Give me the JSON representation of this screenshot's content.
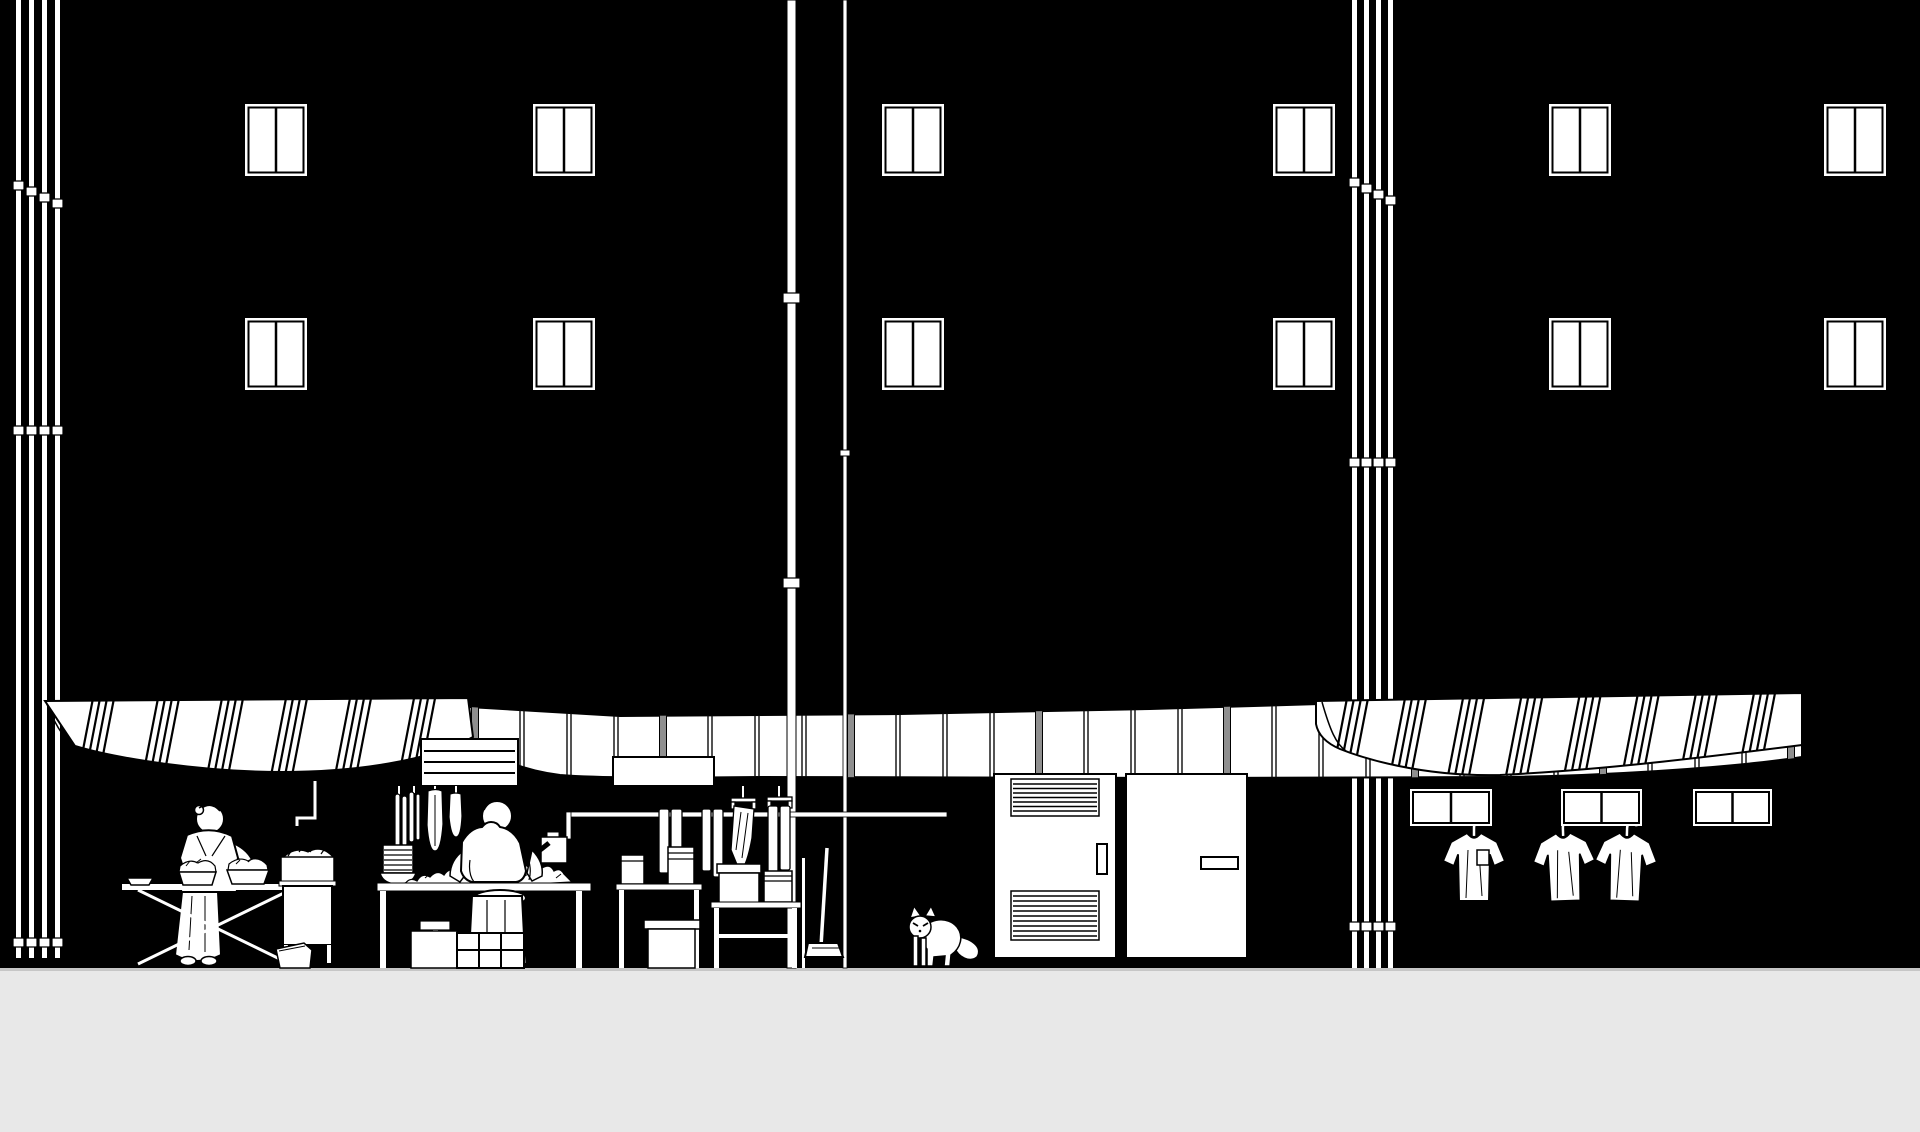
{
  "scene_title": "Night market street elevation",
  "colors": {
    "background": "#000000",
    "ink": "#000000",
    "paper": "#ffffff",
    "ground": "#e8e8e8",
    "ground_edge": "#c6c6c6",
    "awning_divider": "#8f8f8f"
  },
  "counts": {
    "facade_windows": 12,
    "facade_window_rows": 2,
    "facade_window_columns": 6,
    "transom_windows": 3,
    "hanging_shirts": 3,
    "left_downpipes": 4,
    "right_downpipes": 4,
    "center_standpipes": 2,
    "awnings": 3,
    "people": 2,
    "cats": 1,
    "doors": 2
  },
  "labels": {
    "scene": "Black-and-white street elevation of a night market beneath a dark apartment facade",
    "ground": "sidewalk",
    "facade_windows": "apartment windows",
    "downpipes_left": "bundle of downpipes",
    "downpipes_right": "bundle of downpipes",
    "standpipes_center": "standpipes with joints",
    "awning_middle": "segmented panel awning",
    "awning_left": "striped fabric awning",
    "awning_right": "striped fabric awning",
    "sign_slatted": "slatted sign board",
    "sign_blank": "blank sign board",
    "produce_stall": "produce stall with standing vendor",
    "butcher_stall": "butcher stall with seated vendor and hanging meats",
    "hanging_rail": "pipe rail with hanging towels",
    "side_tables": "side tables with storage boxes",
    "broom": "broom leaning at the stall",
    "louvered_door": "louvered utility door",
    "entry_door": "entry door with plate",
    "cat": "stray cat",
    "laundry": "t-shirts drying on hangers",
    "transom_windows": "transom windows"
  }
}
